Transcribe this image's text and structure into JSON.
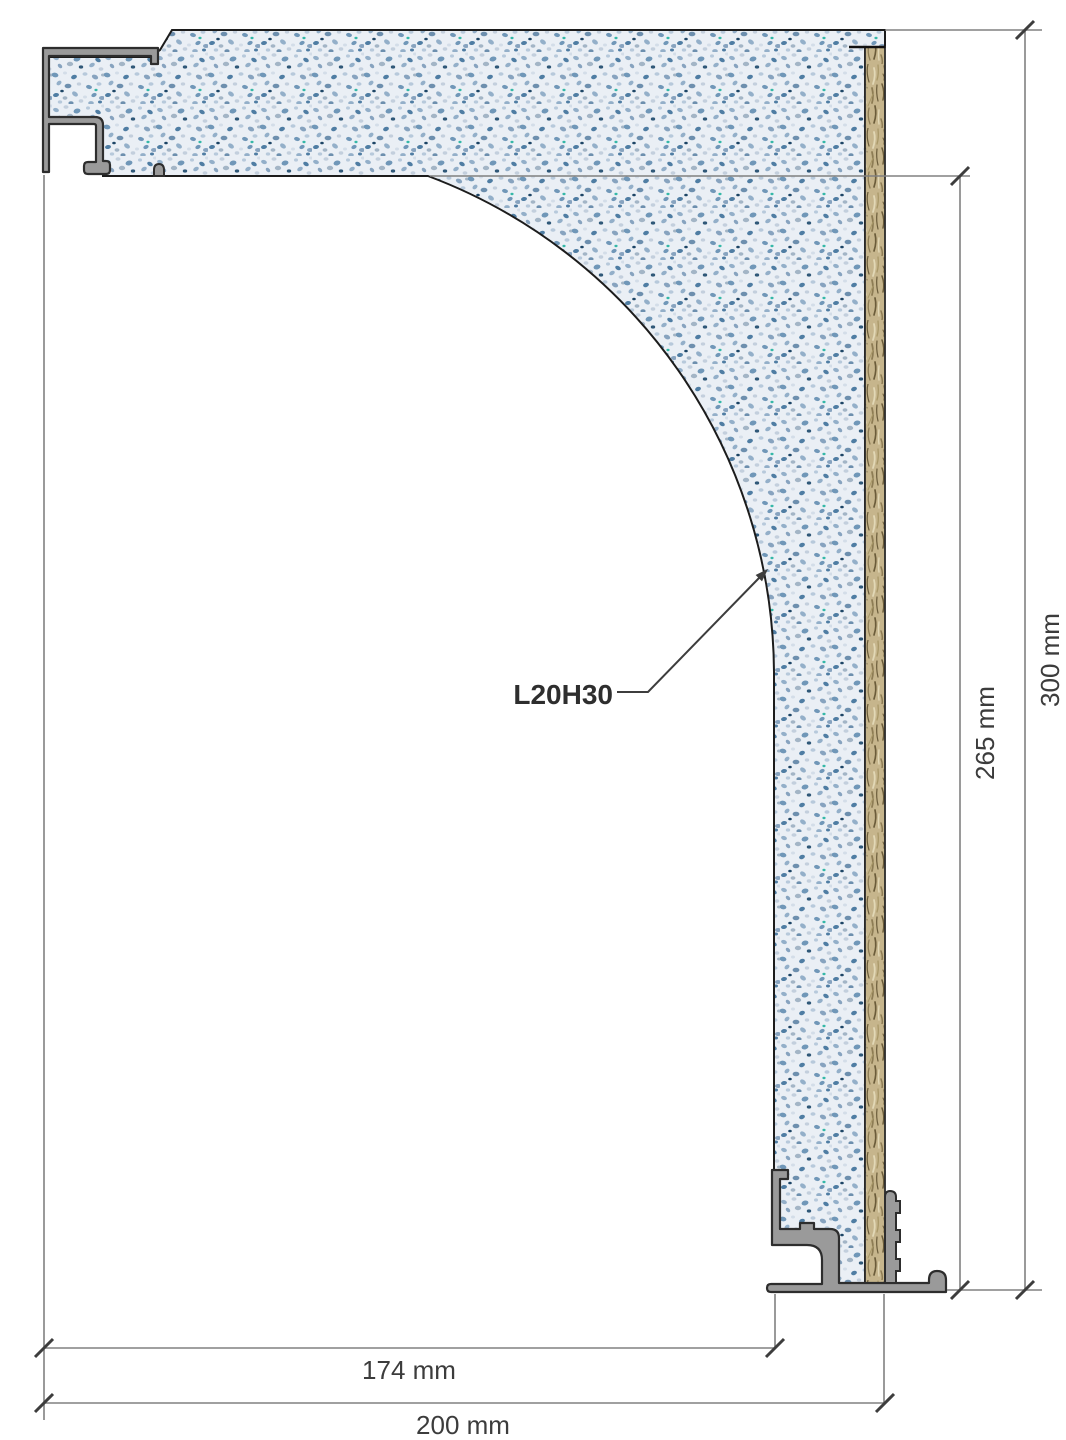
{
  "page": {
    "background": "#ffffff",
    "kind": "technical cross-section drawing of a terrazzo cove skirting element"
  },
  "drawing": {
    "part_label": "L20H30",
    "dimensions": {
      "bottom_inner": "174 mm",
      "bottom_outer": "200 mm",
      "right_inner": "265 mm",
      "right_outer": "300 mm"
    },
    "colors": {
      "terrazzo_base": "#eaeff5",
      "terrazzo_speckle_blue": "#7097b8",
      "wood_wool_board": "#c6b58c",
      "metal_profile_fill": "#9a9a9a",
      "outline": "#1c1c1c",
      "dimension_line": "#808080",
      "tick_and_leader": "#3d3d3d",
      "text": "#3c3c3c"
    }
  }
}
